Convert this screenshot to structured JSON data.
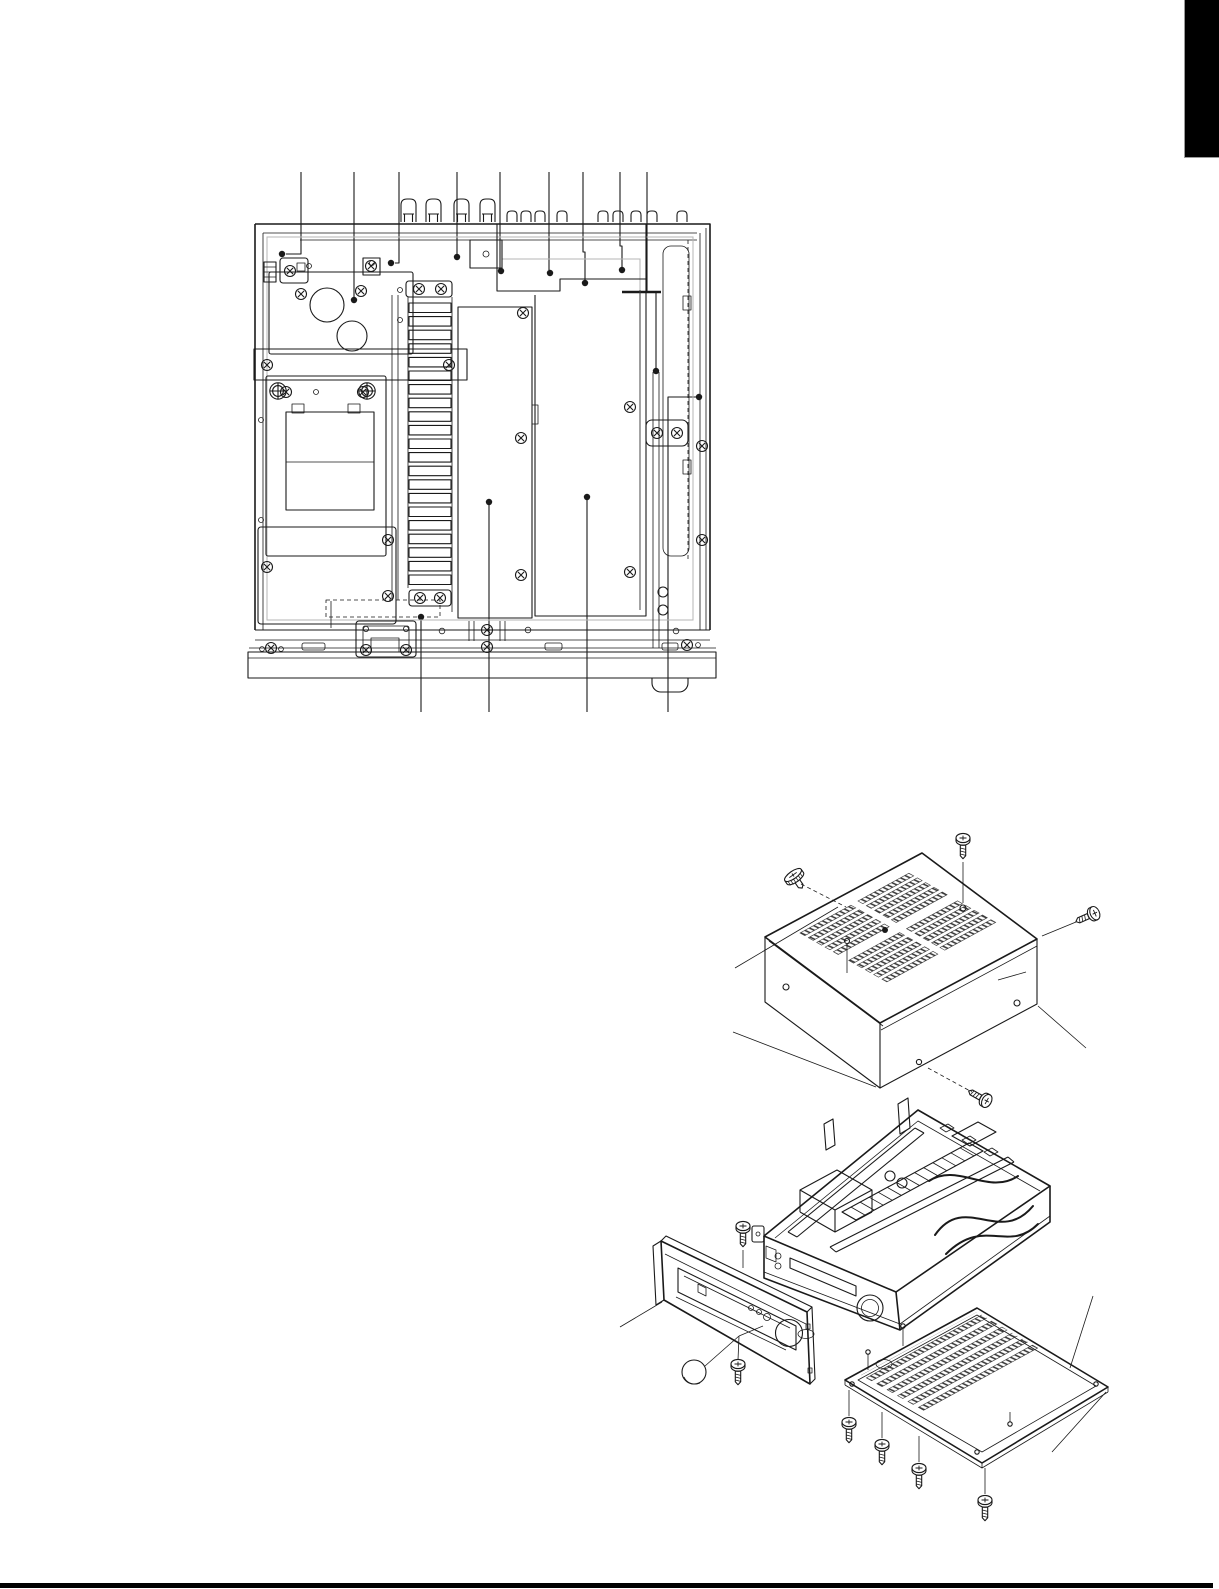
{
  "page": {
    "background": "#ffffff",
    "ink": "#1a1a1a",
    "corner_tab_color": "#000000",
    "footer_rule_color": "#000000",
    "gray_line_color": "#b5b5b5"
  },
  "figure_top_view": {
    "name": "chassis-top-view",
    "leader_lines_up": 9,
    "leader_lines_down": 4,
    "components": [
      "power-supply-board",
      "filter-capacitors",
      "mounting-bracket",
      "power-transformer",
      "shield-plate",
      "heatsink",
      "center-pcb",
      "main-pcb",
      "rear-connectors",
      "front-rail",
      "base-plate",
      "foot"
    ]
  },
  "figure_exploded_view": {
    "name": "cabinet-disassembly-exploded-view",
    "parts": [
      "top-cover",
      "main-chassis",
      "front-panel",
      "control-knob",
      "bottom-cover"
    ],
    "screws": {
      "top_cover": 4,
      "front_panel": 2,
      "bottom_cover": 4
    },
    "vent_strip_groups_top_cover": 4,
    "vent_strips_bottom_cover": 7
  }
}
